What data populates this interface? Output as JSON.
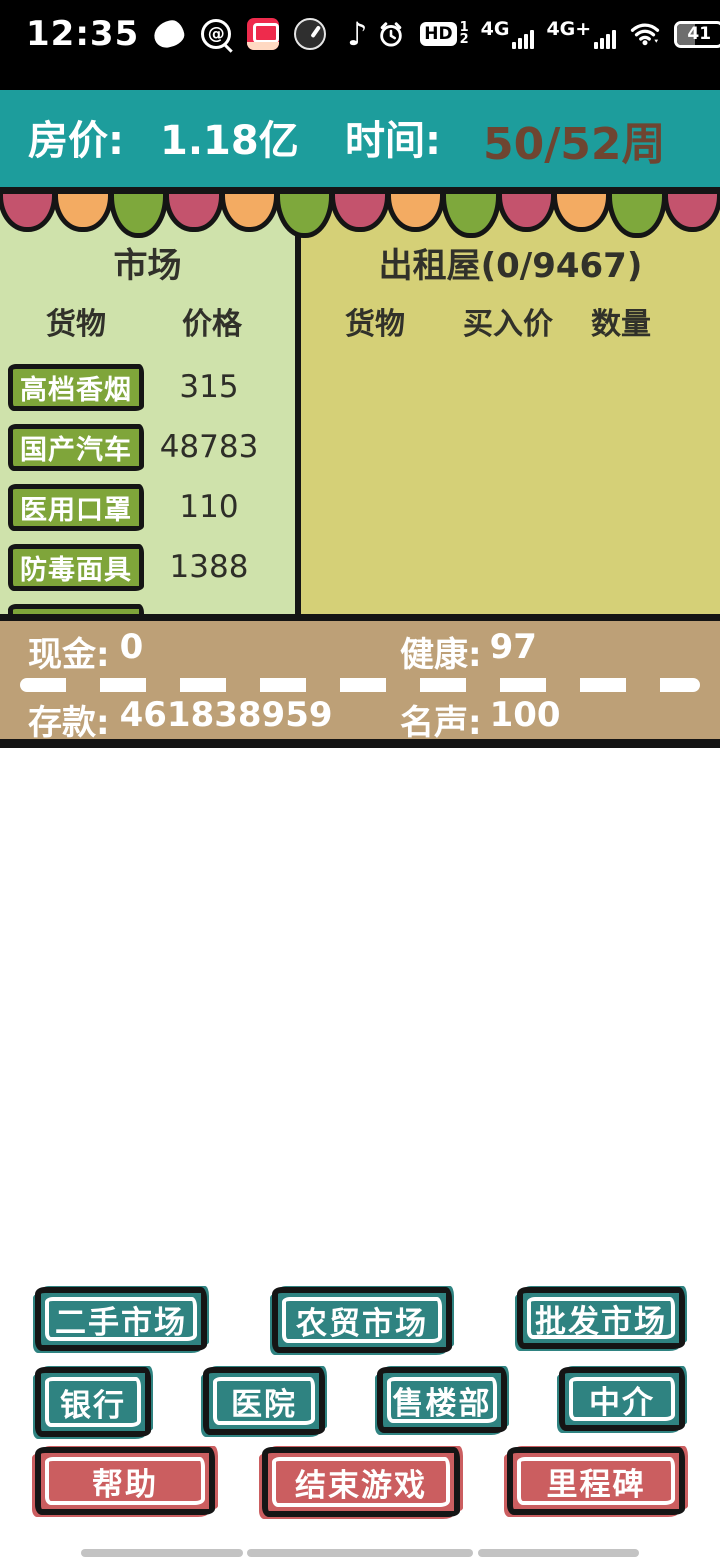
{
  "status_bar": {
    "time": "12:35",
    "hd": "HD",
    "sim1": "1",
    "sim2": "2",
    "net_a": "4G",
    "net_b": "4G+",
    "battery": "41",
    "note_glyph": "♪",
    "at_glyph": "@"
  },
  "header": {
    "house_price_label": "房价:",
    "house_price_value": "1.18亿",
    "time_label": "时间:",
    "time_value": "50/52周"
  },
  "market": {
    "title": "市场",
    "col_goods": "货物",
    "col_price": "价格",
    "items": [
      {
        "name": "高档香烟",
        "price": "315"
      },
      {
        "name": "国产汽车",
        "price": "48783"
      },
      {
        "name": "医用口罩",
        "price": "110"
      },
      {
        "name": "防毒面具",
        "price": "1388"
      },
      {
        "name": "饲料肉鸡",
        "price": "181"
      }
    ]
  },
  "rental": {
    "title": "出租屋(0/9467)",
    "col_goods": "货物",
    "col_buy": "买入价",
    "col_qty": "数量",
    "items": []
  },
  "stats": {
    "cash_label": "现金:",
    "cash": "0",
    "health_label": "健康:",
    "health": "97",
    "deposit_label": "存款:",
    "deposit": "461838959",
    "fame_label": "名声:",
    "fame": "100"
  },
  "actions": {
    "row1": [
      "二手市场",
      "农贸市场",
      "批发市场"
    ],
    "row2": [
      "银行",
      "医院",
      "售楼部",
      "中介"
    ],
    "row3": [
      "帮助",
      "结束游戏",
      "里程碑"
    ]
  },
  "colors": {
    "header_teal": "#1d9d9c",
    "flag_pink": "#c4536d",
    "flag_orange": "#f3ab62",
    "flag_green": "#7ea83c",
    "market_panel_bg": "#cfe2ab",
    "rental_panel_bg": "#d5d077",
    "item_button_green": "#7fa53a",
    "road_tan": "#bda077",
    "button_teal": "#2f8381",
    "button_red": "#cb5e60",
    "time_value_brown": "#6e4531"
  }
}
